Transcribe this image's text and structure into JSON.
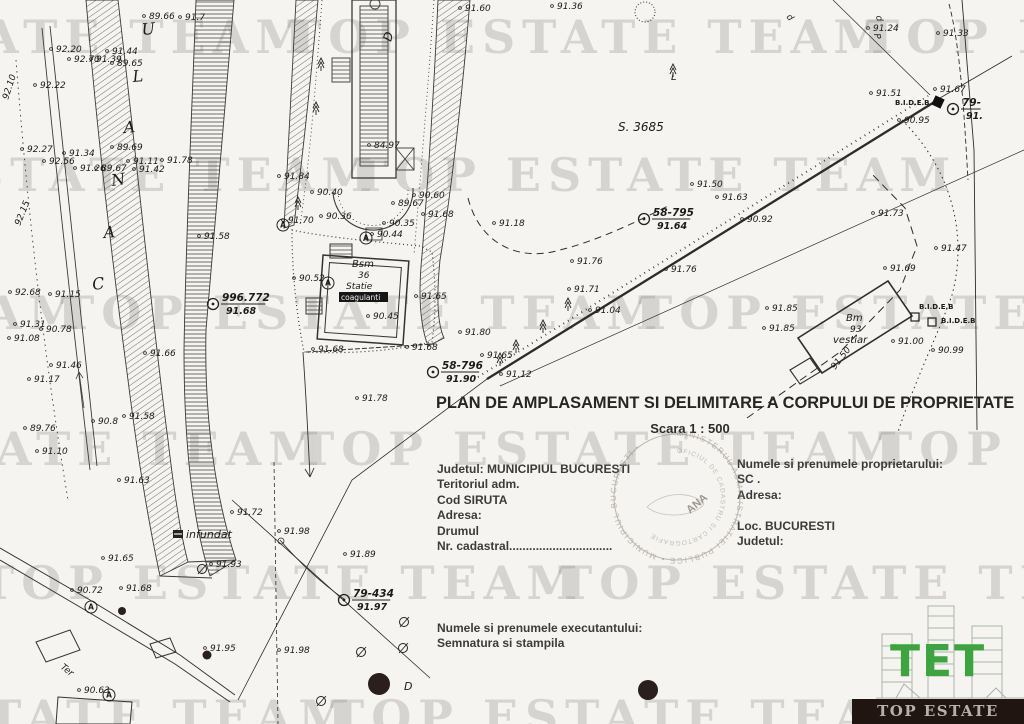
{
  "watermark": {
    "text": "TOP ESTATE TEAM",
    "period": 578,
    "rows": [
      {
        "x": 287,
        "y": 10
      },
      {
        "x": -225,
        "y": 148
      },
      {
        "x": 60,
        "y": 286
      },
      {
        "x": 300,
        "y": 422
      },
      {
        "x": -20,
        "y": 556
      },
      {
        "x": 330,
        "y": 690
      }
    ]
  },
  "title_block": {
    "title": "PLAN DE AMPLASAMENT SI DELIMITARE A CORPULUI DE PROPRIETATE",
    "scale": "Scara 1 : 500",
    "left": [
      "Judetul: MUNICIPIUL BUCURESTI",
      "Teritoriul adm.",
      "Cod SIRUTA",
      "Adresa:",
      "Drumul",
      "Nr. cadastral..............................."
    ],
    "right": [
      "Numele si prenumele proprietarului:",
      "SC .",
      "Adresa:",
      "",
      "Loc. BUCURESTI",
      "Judetul:"
    ],
    "executor": [
      "Numele si prenumele executantului:",
      "Semnatura si stampila"
    ]
  },
  "stamp": {
    "ring": "MINISTERUL ADMINISTRATIEI PUBLICE • MUNICIPIUL BUCURESTI • ",
    "inner": "OFICIUL DE CADASTRU SI CARTOGRAFIE",
    "center": "ANA"
  },
  "logo": {
    "initials": "TET",
    "banner": "TOP ESTATE TEAM",
    "green": "#3da53f"
  },
  "map": {
    "points": [
      [
        56,
        52,
        "92.20"
      ],
      [
        74,
        62,
        "92.70"
      ],
      [
        96,
        62,
        "91.39"
      ],
      [
        112,
        54,
        "91.44"
      ],
      [
        117,
        66,
        "89.65"
      ],
      [
        149,
        19,
        "89.66"
      ],
      [
        185,
        20,
        "91.7"
      ],
      [
        40,
        88,
        "92.22"
      ],
      [
        8,
        100,
        "92.10",
        -72
      ],
      [
        27,
        152,
        "92.27"
      ],
      [
        69,
        156,
        "91.34"
      ],
      [
        49,
        164,
        "92.56"
      ],
      [
        80,
        171,
        "91.26"
      ],
      [
        101,
        171,
        "89.67"
      ],
      [
        117,
        150,
        "89.69"
      ],
      [
        133,
        164,
        "91.11"
      ],
      [
        167,
        163,
        "91.78"
      ],
      [
        139,
        172,
        "91.42"
      ],
      [
        20,
        226,
        "92.15",
        -68
      ],
      [
        204,
        239,
        "91.58"
      ],
      [
        15,
        295,
        "92.68"
      ],
      [
        55,
        297,
        "91.15"
      ],
      [
        20,
        327,
        "91.31"
      ],
      [
        14,
        341,
        "91.08"
      ],
      [
        46,
        332,
        "90.78"
      ],
      [
        56,
        368,
        "91.46"
      ],
      [
        34,
        382,
        "91.17"
      ],
      [
        150,
        356,
        "91.66"
      ],
      [
        30,
        431,
        "89.76"
      ],
      [
        129,
        419,
        "91.58"
      ],
      [
        98,
        424,
        "90.8"
      ],
      [
        42,
        454,
        "91.10"
      ],
      [
        124,
        483,
        "91.63"
      ],
      [
        374,
        148,
        "84.97"
      ],
      [
        465,
        11,
        "91.60"
      ],
      [
        557,
        9,
        "91.36"
      ],
      [
        873,
        31,
        "91.24"
      ],
      [
        943,
        36,
        "91.33"
      ],
      [
        876,
        96,
        "91.51"
      ],
      [
        904,
        123,
        "90.95"
      ],
      [
        940,
        92,
        "91.67"
      ],
      [
        284,
        179,
        "91.84"
      ],
      [
        317,
        195,
        "90.40"
      ],
      [
        419,
        198,
        "90.60"
      ],
      [
        398,
        206,
        "89.67"
      ],
      [
        326,
        219,
        "90.36"
      ],
      [
        389,
        226,
        "90.35"
      ],
      [
        428,
        217,
        "91.68"
      ],
      [
        288,
        223,
        "91.70"
      ],
      [
        377,
        237,
        "90.44"
      ],
      [
        299,
        281,
        "90.52"
      ],
      [
        421,
        299,
        "91.65"
      ],
      [
        373,
        319,
        "90.45"
      ],
      [
        318,
        352,
        "91.68"
      ],
      [
        412,
        350,
        "91.68"
      ],
      [
        487,
        358,
        "91.65"
      ],
      [
        506,
        377,
        "91.12"
      ],
      [
        465,
        335,
        "91.80"
      ],
      [
        499,
        226,
        "91.18"
      ],
      [
        577,
        264,
        "91.76"
      ],
      [
        574,
        292,
        "91.71"
      ],
      [
        595,
        313,
        "91.04"
      ],
      [
        671,
        272,
        "91.76"
      ],
      [
        697,
        187,
        "91.50"
      ],
      [
        722,
        200,
        "91.63"
      ],
      [
        747,
        222,
        "90.92"
      ],
      [
        878,
        216,
        "91.73"
      ],
      [
        941,
        251,
        "91.47"
      ],
      [
        890,
        271,
        "91.69"
      ],
      [
        772,
        311,
        "91.85"
      ],
      [
        769,
        331,
        "91.85"
      ],
      [
        898,
        344,
        "91.00"
      ],
      [
        938,
        353,
        "90.99"
      ],
      [
        835,
        370,
        "91.50",
        -52
      ],
      [
        362,
        401,
        "91.78"
      ],
      [
        237,
        515,
        "91.72"
      ],
      [
        284,
        534,
        "91.98"
      ],
      [
        108,
        561,
        "91.65"
      ],
      [
        216,
        567,
        "91.93"
      ],
      [
        77,
        593,
        "90.72"
      ],
      [
        126,
        591,
        "91.68"
      ],
      [
        350,
        557,
        "91.89"
      ],
      [
        210,
        651,
        "91.95"
      ],
      [
        284,
        653,
        "91.98"
      ],
      [
        84,
        693,
        "90.63"
      ]
    ],
    "benchmarks": [
      {
        "x": 644,
        "y": 219,
        "label": "58-795",
        "elev": "91.64"
      },
      {
        "x": 433,
        "y": 372,
        "label": "58-796",
        "elev": "91.90"
      },
      {
        "x": 344,
        "y": 600,
        "label": "79-434",
        "elev": "91.97"
      },
      {
        "x": 953,
        "y": 109,
        "label": "79-",
        "elev": "91."
      },
      {
        "x": 213,
        "y": 304,
        "label": "996.772",
        "elev": "91.68"
      }
    ],
    "control_point_letter": "A",
    "control_points": [
      [
        283,
        225
      ],
      [
        366,
        238
      ],
      [
        328,
        283
      ],
      [
        91,
        607
      ],
      [
        109,
        695
      ]
    ],
    "features": [
      {
        "t": "C",
        "x": 93,
        "y": 290,
        "s": 16,
        "cls": "canal",
        "r": -8
      },
      {
        "t": "A",
        "x": 104,
        "y": 238,
        "s": 16,
        "cls": "canal",
        "r": -5
      },
      {
        "t": "N",
        "x": 112,
        "y": 186,
        "s": 16,
        "cls": "canal",
        "r": -8
      },
      {
        "t": "A",
        "x": 124,
        "y": 133,
        "s": 16,
        "cls": "canal",
        "r": -5
      },
      {
        "t": "L",
        "x": 133,
        "y": 82,
        "s": 16,
        "cls": "canal",
        "r": -5
      },
      {
        "t": "U",
        "x": 142,
        "y": 35,
        "s": 16,
        "cls": "canal",
        "r": -5
      },
      {
        "t": "S. 3685",
        "x": 618,
        "y": 131,
        "s": 12,
        "cls": "feat"
      },
      {
        "t": "D",
        "x": 391,
        "y": 42,
        "s": 12,
        "cls": "feat",
        "r": -75
      },
      {
        "t": "D",
        "x": 404,
        "y": 690,
        "s": 11,
        "cls": "feat"
      },
      {
        "t": "Ter",
        "x": 60,
        "y": 668,
        "s": 9,
        "cls": "feat",
        "r": 38
      },
      {
        "t": "infundat",
        "x": 186,
        "y": 538,
        "s": 11,
        "cls": "feat"
      },
      {
        "t": "B.I.D.E.B",
        "x": 895,
        "y": 105,
        "s": 7,
        "cls": "bid"
      },
      {
        "t": "B.I.D.E.B",
        "x": 919,
        "y": 309,
        "s": 7,
        "cls": "bid"
      },
      {
        "t": "B.I.D.E.B",
        "x": 941,
        "y": 323,
        "s": 7,
        "cls": "bid"
      },
      {
        "t": "Bsm",
        "x": 352,
        "y": 267,
        "s": 10,
        "cls": "feat"
      },
      {
        "t": "36",
        "x": 358,
        "y": 278,
        "s": 9,
        "cls": "feat"
      },
      {
        "t": "Statie",
        "x": 346,
        "y": 289,
        "s": 9,
        "cls": "feat"
      },
      {
        "t": "coagulanti",
        "x": 341,
        "y": 300,
        "s": 7.5,
        "cls": "inv"
      },
      {
        "t": "Bm",
        "x": 846,
        "y": 321,
        "s": 10,
        "cls": "feat"
      },
      {
        "t": "93",
        "x": 850,
        "y": 332,
        "s": 9,
        "cls": "feat"
      },
      {
        "t": "vestiar",
        "x": 833,
        "y": 343,
        "s": 10,
        "cls": "feat"
      },
      {
        "t": "P",
        "x": 874,
        "y": 34,
        "s": 9,
        "cls": "feat",
        "r": 80
      },
      {
        "t": "d",
        "x": 876,
        "y": 16,
        "s": 9,
        "cls": "feat",
        "r": 80
      },
      {
        "t": "d",
        "x": 786,
        "y": 17,
        "s": 9,
        "cls": "feat",
        "r": 50
      },
      {
        "t": "L",
        "x": 671,
        "y": 80,
        "s": 10,
        "cls": "feat"
      }
    ],
    "open_squares": [
      [
        911,
        313
      ],
      [
        928,
        318
      ]
    ],
    "filled_squares": [
      [
        933,
        97
      ]
    ],
    "black_dots": [
      [
        122,
        611,
        4
      ],
      [
        207,
        655,
        4.5
      ],
      [
        379,
        684,
        11
      ],
      [
        648,
        690,
        10
      ]
    ],
    "manholes": [
      [
        404,
        622
      ],
      [
        361,
        652
      ],
      [
        403,
        648
      ],
      [
        202,
        569
      ],
      [
        321,
        701
      ]
    ],
    "trees": [
      [
        318,
        58
      ],
      [
        313,
        102
      ],
      [
        295,
        197
      ],
      [
        565,
        298
      ],
      [
        540,
        320
      ],
      [
        513,
        340
      ],
      [
        497,
        353
      ],
      [
        670,
        64
      ]
    ]
  }
}
